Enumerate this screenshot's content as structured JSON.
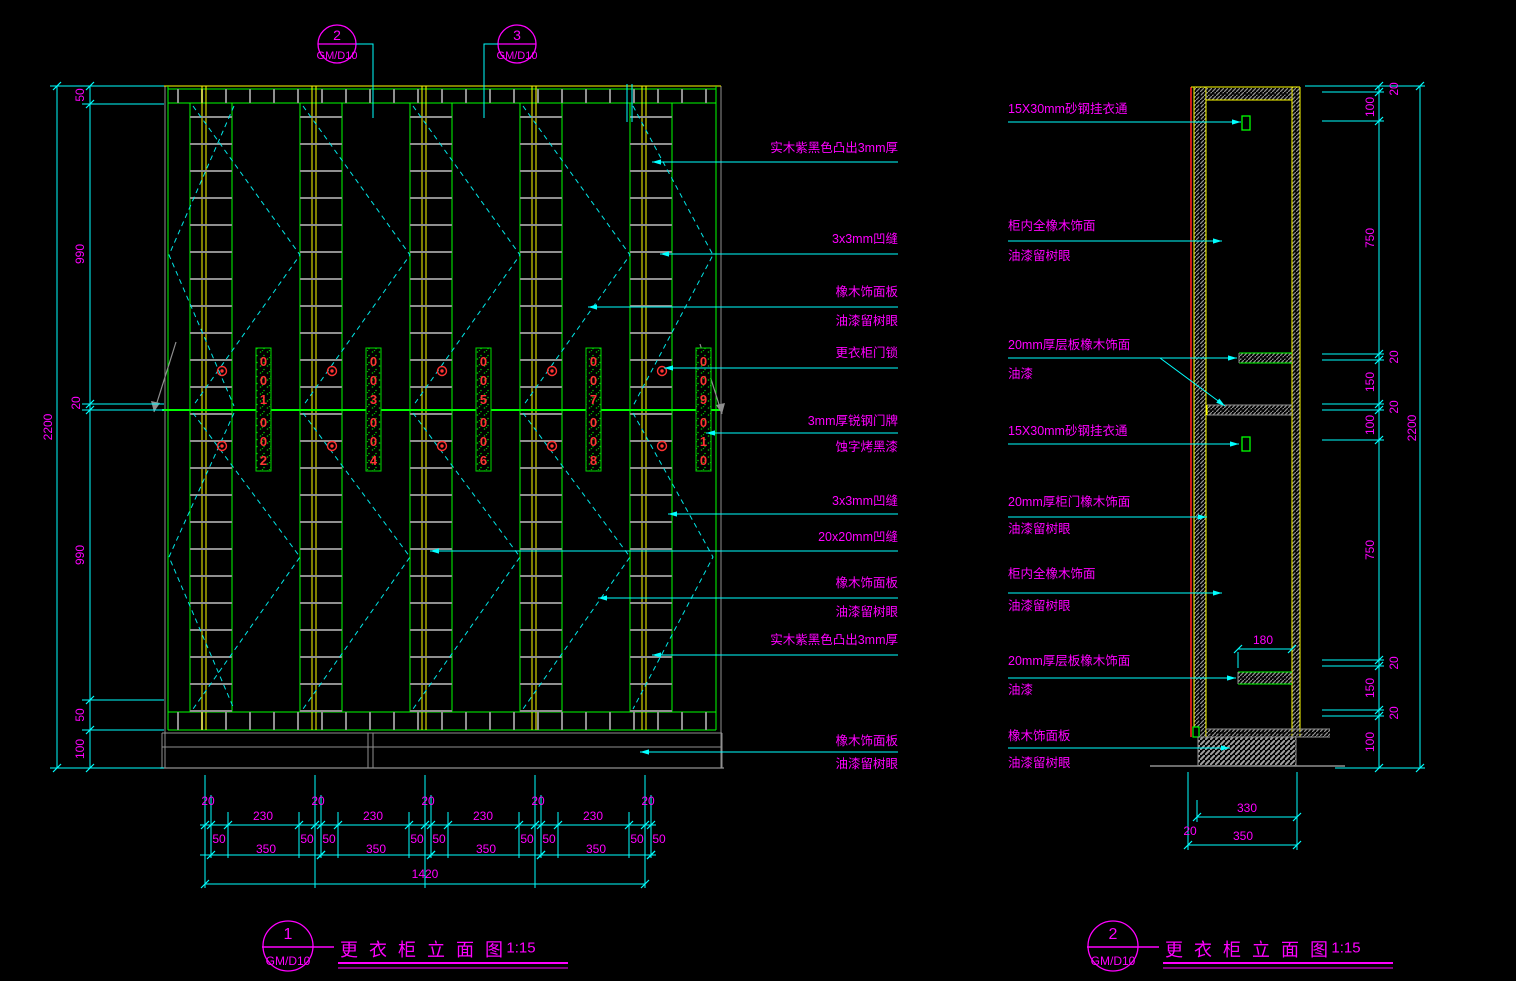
{
  "colors": {
    "background": "#000000",
    "annotation_magenta": "#FF00FF",
    "dimension_cyan": "#00FFFF",
    "cabinet_green": "#00FF00",
    "panel_yellow": "#FFFF00",
    "hatch_gray": "#8F8F8F",
    "lock_red": "#FF3333"
  },
  "callouts": [
    {
      "number": "2",
      "ref": "GM/D10"
    },
    {
      "number": "3",
      "ref": "GM/D10"
    }
  ],
  "elevation": {
    "annotations": [
      [
        "实木紫黑色凸出3mm厚"
      ],
      [
        "3x3mm凹缝"
      ],
      [
        "橡木饰面板",
        "油漆留树眼"
      ],
      [
        "更衣柜门锁"
      ],
      [
        "3mm厚锐钢门牌",
        "蚀字烤黑漆"
      ],
      [
        "3x3mm凹缝"
      ],
      [
        "20x20mm凹缝"
      ],
      [
        "橡木饰面板",
        "油漆留树眼"
      ],
      [
        "实木紫黑色凸出3mm厚"
      ],
      [
        "橡木饰面板",
        "油漆留树眼"
      ]
    ],
    "left_chain": [
      "50",
      "990",
      "20",
      "990",
      "50",
      "100"
    ],
    "left_total": "2200",
    "bottom": {
      "t20": [
        "20",
        "20",
        "20",
        "20",
        "20"
      ],
      "t230": [
        "230",
        "230",
        "230",
        "230"
      ],
      "t50": [
        "50",
        "50",
        "50",
        "50",
        "50",
        "50",
        "50",
        "50",
        "50"
      ],
      "t350": [
        "350",
        "350",
        "350",
        "350"
      ],
      "total": "1420"
    },
    "plates": [
      [
        "0",
        "0",
        "1",
        "0",
        "0",
        "2"
      ],
      [
        "0",
        "0",
        "3",
        "0",
        "0",
        "4"
      ],
      [
        "0",
        "0",
        "5",
        "0",
        "0",
        "6"
      ],
      [
        "0",
        "0",
        "7",
        "0",
        "0",
        "8"
      ],
      [
        "0",
        "0",
        "9",
        "0",
        "1",
        "0"
      ]
    ]
  },
  "section": {
    "annotations": [
      [
        "15X30mm砂钢挂衣通"
      ],
      [
        "柜内全橡木饰面",
        "油漆留树眼"
      ],
      [
        "20mm厚层板橡木饰面",
        "油漆"
      ],
      [
        "15X30mm砂钢挂衣通"
      ],
      [
        "20mm厚柜门橡木饰面",
        "油漆留树眼"
      ],
      [
        "柜内全橡木饰面",
        "油漆留树眼"
      ],
      [
        "20mm厚层板橡木饰面",
        "油漆"
      ],
      [
        "橡木饰面板",
        "油漆留树眼"
      ]
    ],
    "right_chain": [
      "20",
      "100",
      "750",
      "20",
      "150",
      "20",
      "100",
      "750",
      "20",
      "150",
      "20",
      "100"
    ],
    "right_total": "2200",
    "shelf_width": "180",
    "bottom": {
      "b20": "20",
      "b330": "330",
      "b350": "350"
    }
  },
  "titles": [
    {
      "number": "1",
      "ref": "GM/D10",
      "title": "更衣柜立面图",
      "scale": "1:15"
    },
    {
      "number": "2",
      "ref": "GM/D10",
      "title": "更衣柜立面图",
      "scale": "1:15"
    }
  ]
}
